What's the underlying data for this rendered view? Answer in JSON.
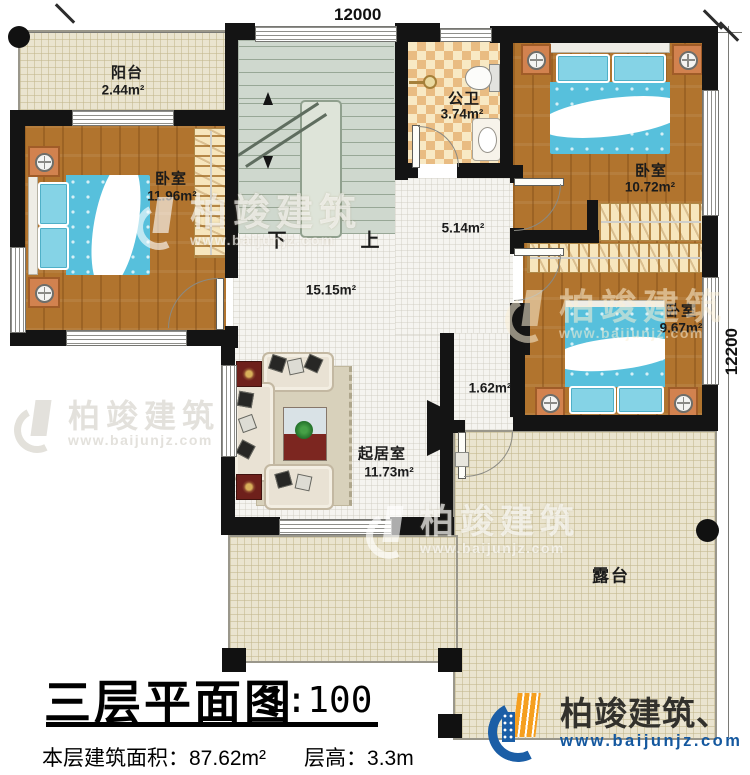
{
  "dims": {
    "width": "12000",
    "height": "12200"
  },
  "stairs": {
    "down": "下",
    "up": "上"
  },
  "rooms": {
    "balcony": {
      "name": "阳台",
      "area": "2.44m²"
    },
    "bedroom_left": {
      "name": "卧室",
      "area": "11.96m²"
    },
    "bathroom": {
      "name": "公卫",
      "area": "3.74m²"
    },
    "bedroom_top_right": {
      "name": "卧室",
      "area": "10.72m²"
    },
    "bedroom_mid_right": {
      "name": "卧室",
      "area": "9.67m²"
    },
    "corridor": {
      "area": "5.14m²"
    },
    "hall": {
      "area": "15.15m²"
    },
    "vestibule": {
      "area": "1.62m²"
    },
    "living": {
      "name": "起居室",
      "area": "11.73m²"
    },
    "terrace": {
      "name": "露台"
    }
  },
  "title": {
    "text": "三层平面图",
    "scale": "1:100",
    "floor_area_label": "本层建筑面积：",
    "floor_area_value": "87.62m²",
    "height_label": "层高：",
    "height_value": "3.3m"
  },
  "brand": {
    "name": "柏竣建筑",
    "mark_name": "柏竣建筑、",
    "url": "www.baijunjz.com"
  },
  "colors": {
    "wall": "#141414",
    "wood": "#b1742e",
    "bed": "#57c0dc",
    "terrace": "#eae4cf",
    "stair": "#cfd8ce",
    "accent_blue": "#1b5ea6",
    "accent_orange": "#f59f1f"
  }
}
